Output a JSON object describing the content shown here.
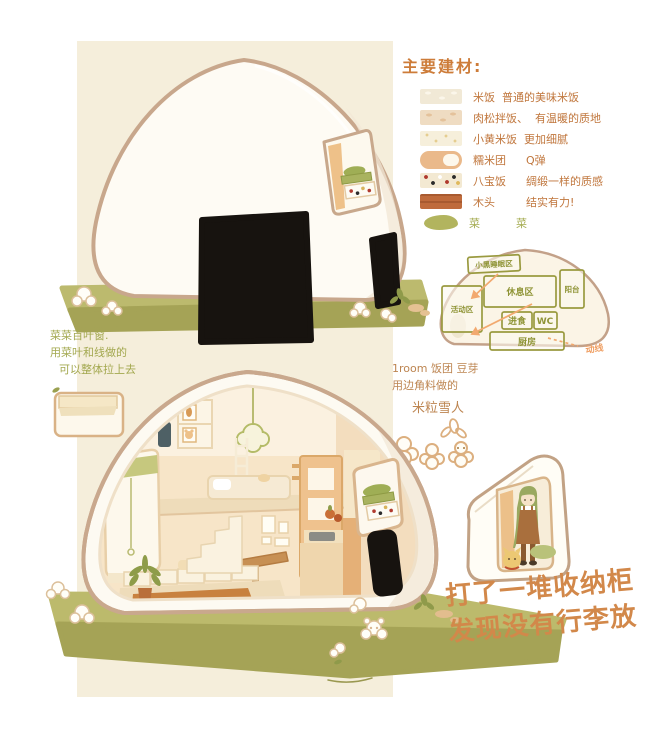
{
  "colors": {
    "panel_bg": "#f5eedb",
    "legend_text": "#c0763c",
    "legend_title": "#cd7c39",
    "green_text": "#a3a84f",
    "caption_orange": "#d2884a",
    "mat_green": "#b2b062",
    "nori_black": "#17130f",
    "shell_outline": "#c8a68a",
    "plan_room_line": "#9a9a40",
    "flow_orange": "#f2a96f"
  },
  "materials_legend": {
    "title": "主要建材:",
    "items": [
      {
        "swatch": "plain-rice",
        "name": "米饭",
        "desc": "普通的美味米饭"
      },
      {
        "swatch": "pork-floss-rice",
        "name": "肉松拌饭、",
        "desc": "有温暖的质地"
      },
      {
        "swatch": "millet-rice",
        "name": "小黄米饭",
        "desc": "更加细腻"
      },
      {
        "swatch": "glutinous-rice-ball",
        "name": "糯米团",
        "desc": "Q弹"
      },
      {
        "swatch": "eight-treasure-rice",
        "name": "八宝饭",
        "desc": "绸缎一样的质感"
      },
      {
        "swatch": "wood",
        "name": "木头",
        "desc": "结实有力!"
      },
      {
        "swatch": "vegetable",
        "name": "菜",
        "desc": "菜"
      }
    ]
  },
  "floor_plan": {
    "rooms": {
      "sleep": "小黑睡眠区",
      "rest": "休息区",
      "balcony": "阳台",
      "activity": "活动区",
      "dining": "进食",
      "wc": "WC",
      "kitchen": "厨房"
    },
    "flow_label": "动线"
  },
  "blind_note": {
    "line1": "菜菜百叶窗.",
    "line2": "用菜叶和线做的",
    "line3": "可以整体拉上去"
  },
  "scrap_note": {
    "line1": "1room 饭团 豆芽",
    "line2": "用边角料做的",
    "line3": "米粒雪人"
  },
  "caption": {
    "line1": "打了一堆收纳柜",
    "line2": "发现没有行李放"
  }
}
